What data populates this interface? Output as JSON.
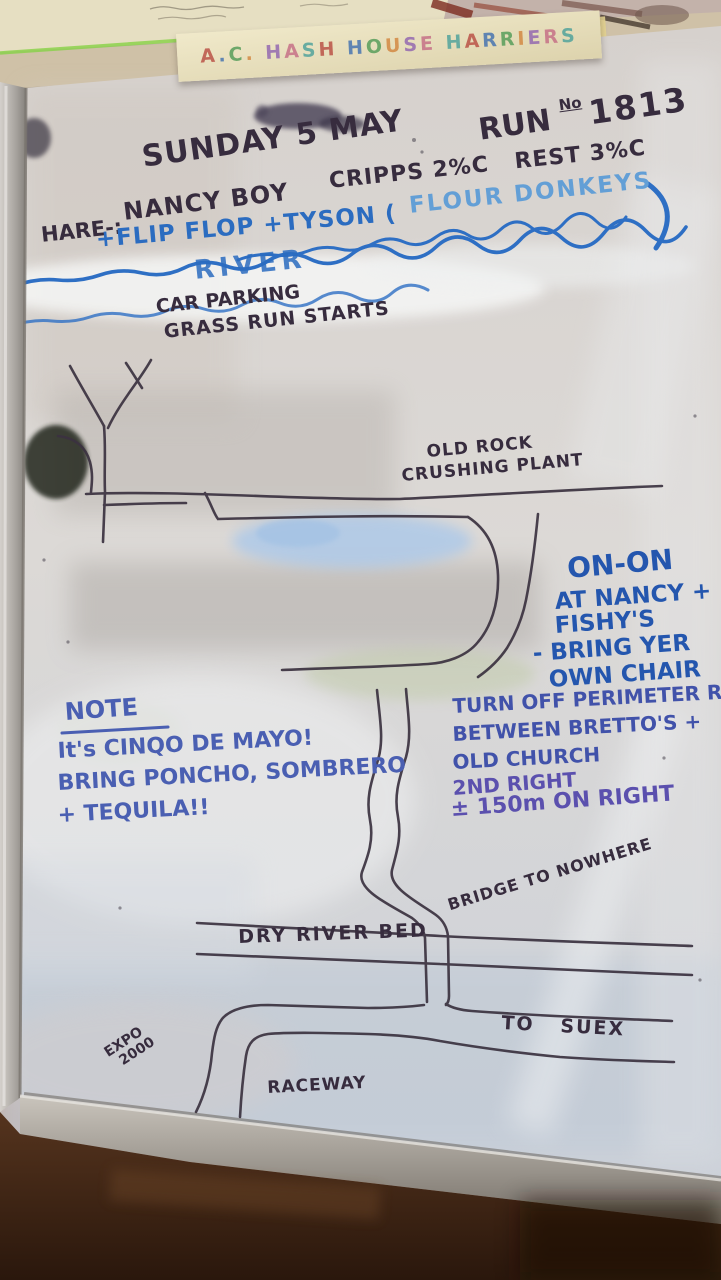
{
  "banner": {
    "text": "A.C. HASH HOUSE HARRIERS"
  },
  "header": {
    "date": "SUNDAY 5 MAY",
    "run_word": "RUN",
    "run_sup": "No",
    "run_number": "1813",
    "hare_label": "HARE-:",
    "hare_name": "NANCY BOY",
    "checkpoints": "CRIPPS 2%C   REST 3%C",
    "cohares_1": "+FLIP FLOP +TYSON (",
    "cohares_2": "FLOUR DONKEYS"
  },
  "river": {
    "label": "RIVER"
  },
  "start_area": {
    "line1": "CAR PARKING",
    "line2": "GRASS RUN STARTS"
  },
  "landmarks": {
    "old_rock_line1": "OLD ROCK",
    "old_rock_line2": "CRUSHING PLANT",
    "bridge": "BRIDGE TO NOWHERE",
    "dry_river_bed": "DRY RIVER BED",
    "to_suex": "TO   SUEX",
    "expo_line1": "EXPO",
    "expo_line2": "2000",
    "raceway": "RACEWAY"
  },
  "on_on": {
    "line1": "ON-ON",
    "line2": "AT NANCY +",
    "line3": "FISHY'S",
    "line4": "- BRING YER",
    "line5": "OWN CHAIR"
  },
  "directions": {
    "line1": "TURN OFF PERIMETER R",
    "line2": "BETWEEN BRETTO'S +",
    "line3": "OLD CHURCH",
    "line4": "2ND RIGHT",
    "line5": "± 150m ON RIGHT"
  },
  "note": {
    "title": "NOTE",
    "line1": "It's CINQO DE MAYO!",
    "line2": "BRING PONCHO, SOMBRERO",
    "line3": "+ TEQUILA!!"
  },
  "colors": {
    "black_marker": "#372c3e",
    "blue_marker": "#2b6cc0",
    "light_blue_marker": "#639fd6",
    "blue_violet_marker": "#4152aa",
    "board": "#d9d5d2",
    "frame_silver": "#b5b1ac",
    "counter_brown": "#3a2214",
    "banner_bg": "#eae2c2",
    "banner_palette": [
      "#b84a40",
      "#3f6fb0",
      "#4f9a55",
      "#d2843c",
      "#8f62b0",
      "#c46a84",
      "#49a09a"
    ]
  }
}
